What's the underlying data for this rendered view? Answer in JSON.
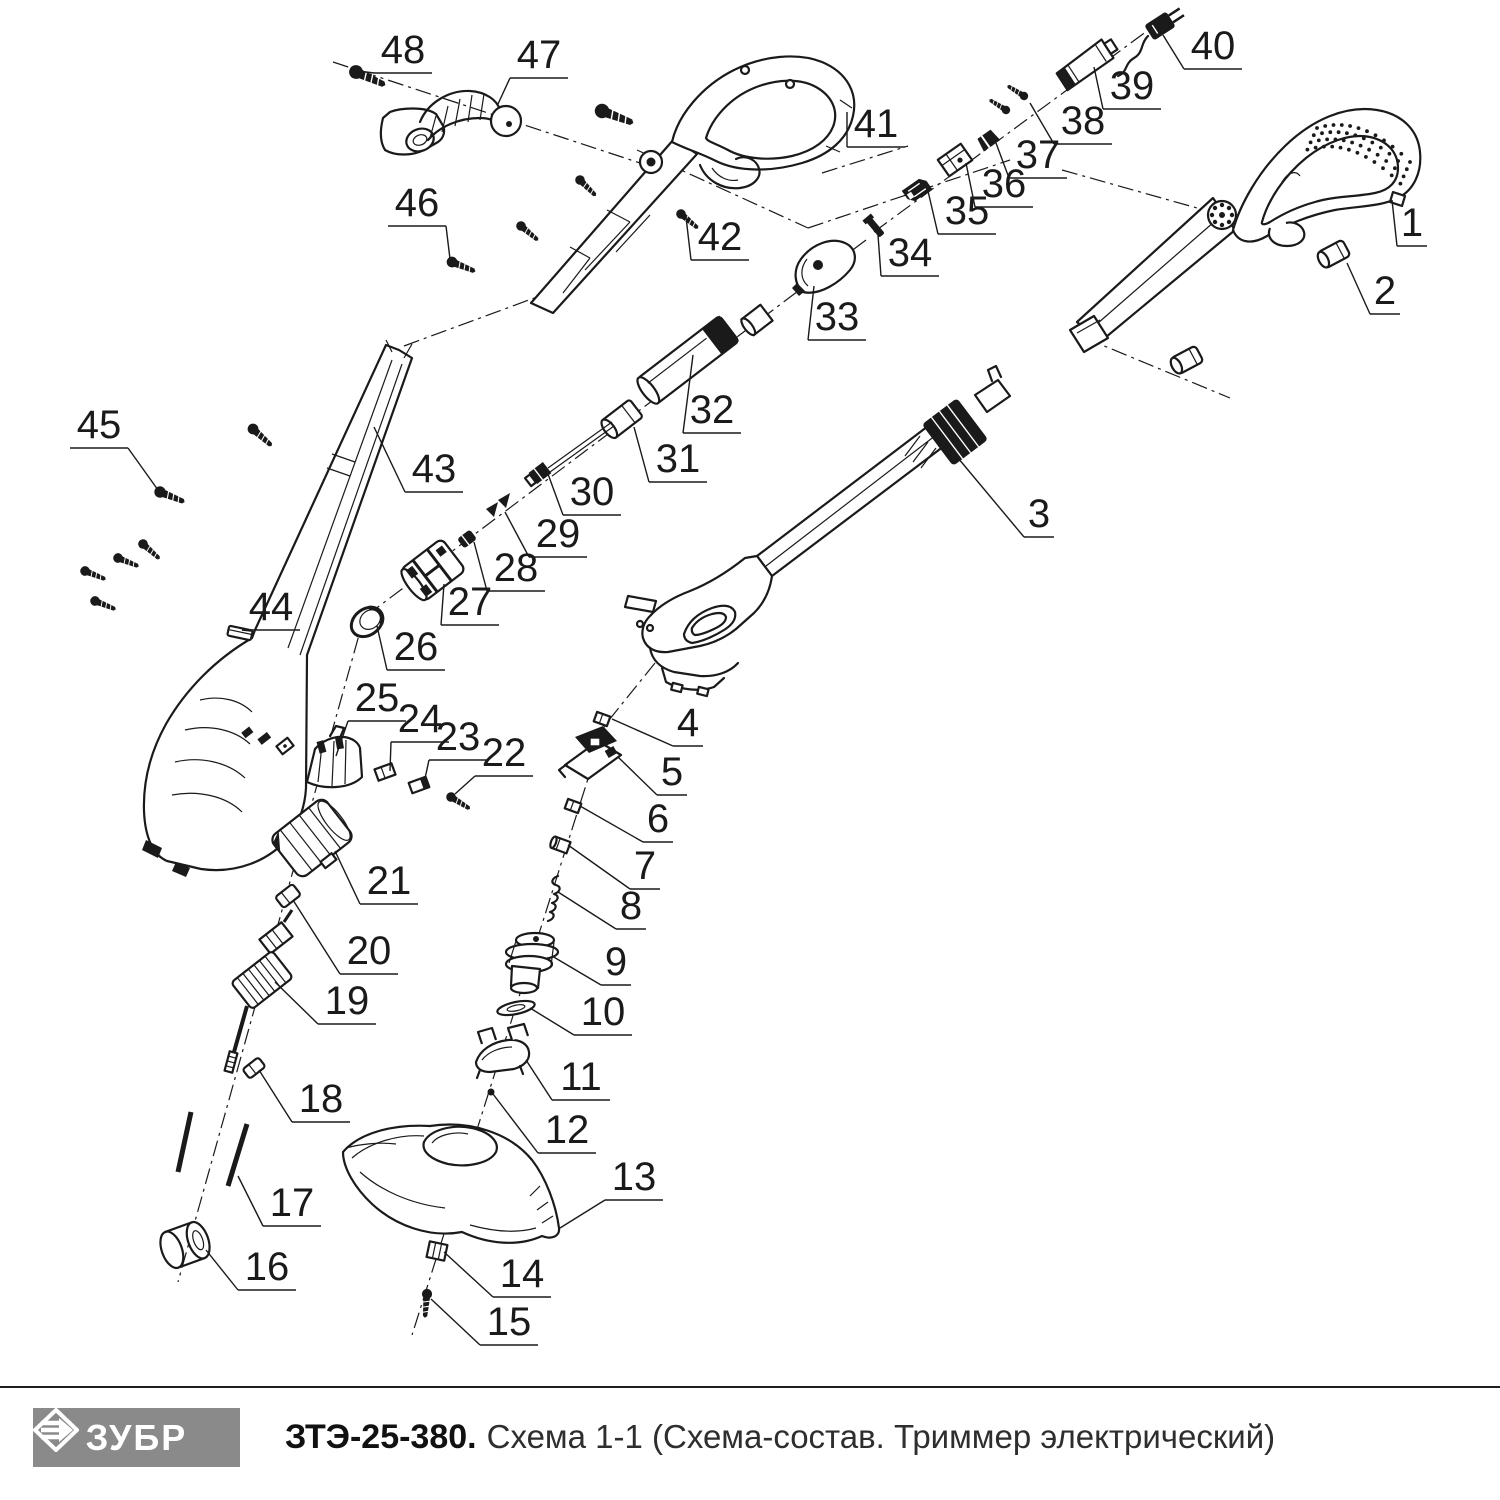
{
  "footer": {
    "brand": "ЗУБР",
    "model": "ЗТЭ-25-380.",
    "caption": "Схема 1-1 (Схема-состав. Триммер электрический)"
  },
  "colors": {
    "ink": "#1a1a1a",
    "logo_bg": "#8a8a8a"
  },
  "diagram": {
    "labels": [
      {
        "n": "1",
        "x": 1412,
        "y": 223,
        "tx": 1392,
        "ty": 200
      },
      {
        "n": "2",
        "x": 1385,
        "y": 291,
        "tx": 1347,
        "ty": 263
      },
      {
        "n": "3",
        "x": 1039,
        "y": 514,
        "tx": 953,
        "ty": 452
      },
      {
        "n": "4",
        "x": 688,
        "y": 723,
        "tx": 612,
        "ty": 719
      },
      {
        "n": "5",
        "x": 672,
        "y": 772,
        "tx": 618,
        "ty": 757
      },
      {
        "n": "6",
        "x": 658,
        "y": 819,
        "tx": 580,
        "ty": 806
      },
      {
        "n": "7",
        "x": 645,
        "y": 866,
        "tx": 568,
        "ty": 845
      },
      {
        "n": "8",
        "x": 631,
        "y": 906,
        "tx": 558,
        "ty": 892
      },
      {
        "n": "9",
        "x": 616,
        "y": 962,
        "tx": 552,
        "ty": 956
      },
      {
        "n": "10",
        "x": 603,
        "y": 1012,
        "tx": 530,
        "ty": 1008
      },
      {
        "n": "11",
        "x": 581,
        "y": 1077,
        "tx": 526,
        "ty": 1060
      },
      {
        "n": "12",
        "x": 567,
        "y": 1130,
        "tx": 493,
        "ty": 1094
      },
      {
        "n": "13",
        "x": 634,
        "y": 1177,
        "tx": 560,
        "ty": 1228
      },
      {
        "n": "14",
        "x": 522,
        "y": 1274,
        "tx": 444,
        "ty": 1252
      },
      {
        "n": "15",
        "x": 509,
        "y": 1322,
        "tx": 431,
        "ty": 1299
      },
      {
        "n": "16",
        "x": 267,
        "y": 1267,
        "tx": 206,
        "ty": 1250
      },
      {
        "n": "17",
        "x": 292,
        "y": 1203,
        "tx": 238,
        "ty": 1176
      },
      {
        "n": "18",
        "x": 321,
        "y": 1099,
        "tx": 259,
        "ty": 1070
      },
      {
        "n": "19",
        "x": 347,
        "y": 1001,
        "tx": 275,
        "ty": 982
      },
      {
        "n": "20",
        "x": 369,
        "y": 951,
        "tx": 293,
        "ty": 900
      },
      {
        "n": "21",
        "x": 389,
        "y": 881,
        "tx": 335,
        "ty": 851
      },
      {
        "n": "22",
        "x": 504,
        "y": 753,
        "tx": 455,
        "ty": 794
      },
      {
        "n": "23",
        "x": 458,
        "y": 737,
        "tx": 424,
        "ty": 783
      },
      {
        "n": "24",
        "x": 420,
        "y": 719,
        "tx": 390,
        "ty": 771
      },
      {
        "n": "25",
        "x": 377,
        "y": 698,
        "tx": 336,
        "ty": 756
      },
      {
        "n": "26",
        "x": 416,
        "y": 647,
        "tx": 377,
        "ty": 626
      },
      {
        "n": "27",
        "x": 470,
        "y": 602,
        "tx": 444,
        "ty": 584
      },
      {
        "n": "28",
        "x": 516,
        "y": 568,
        "tx": 474,
        "ty": 542
      },
      {
        "n": "29",
        "x": 558,
        "y": 534,
        "tx": 505,
        "ty": 512
      },
      {
        "n": "30",
        "x": 592,
        "y": 492,
        "tx": 548,
        "ty": 474
      },
      {
        "n": "31",
        "x": 678,
        "y": 459,
        "tx": 634,
        "ty": 427
      },
      {
        "n": "32",
        "x": 712,
        "y": 410,
        "tx": 693,
        "ty": 355
      },
      {
        "n": "33",
        "x": 837,
        "y": 317,
        "tx": 814,
        "ty": 286
      },
      {
        "n": "34",
        "x": 910,
        "y": 253,
        "tx": 878,
        "ty": 235
      },
      {
        "n": "35",
        "x": 967,
        "y": 211,
        "tx": 928,
        "ty": 191
      },
      {
        "n": "36",
        "x": 1004,
        "y": 184,
        "tx": 966,
        "ty": 163
      },
      {
        "n": "37",
        "x": 1038,
        "y": 155,
        "tx": 996,
        "ty": 143
      },
      {
        "n": "38",
        "x": 1083,
        "y": 121,
        "tx": 1030,
        "ty": 103
      },
      {
        "n": "39",
        "x": 1132,
        "y": 86,
        "tx": 1094,
        "ty": 67
      },
      {
        "n": "40",
        "x": 1213,
        "y": 46,
        "tx": 1163,
        "ty": 35
      },
      {
        "n": "41",
        "x": 876,
        "y": 124,
        "tx": 847,
        "ty": 112
      },
      {
        "n": "42",
        "x": 720,
        "y": 237,
        "tx": 686,
        "ty": 217
      },
      {
        "n": "43",
        "x": 434,
        "y": 469,
        "tx": 374,
        "ty": 427
      },
      {
        "n": "44",
        "x": 271,
        "y": 607,
        "tx": 251,
        "ty": 631
      },
      {
        "n": "45",
        "x": 99,
        "y": 425,
        "tx": 158,
        "ty": 490
      },
      {
        "n": "46",
        "x": 417,
        "y": 203,
        "tx": 450,
        "ty": 259
      },
      {
        "n": "47",
        "x": 539,
        "y": 55,
        "tx": 498,
        "ty": 104
      },
      {
        "n": "48",
        "x": 403,
        "y": 50,
        "tx": 358,
        "ty": 71
      }
    ]
  }
}
